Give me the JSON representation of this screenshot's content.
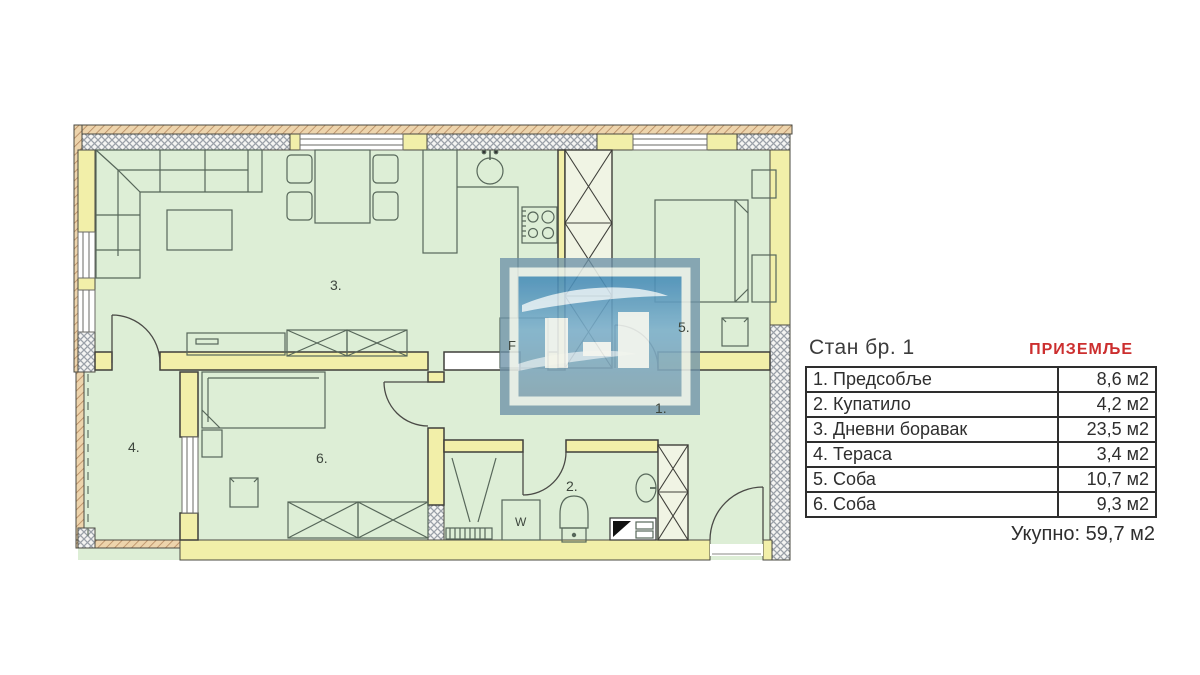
{
  "title": {
    "apartment": "Стан бр. 1",
    "floor": "ПРИЗЕМЉЕ"
  },
  "table": {
    "rows": [
      {
        "name": "1. Предсобље",
        "area": "8,6 м2"
      },
      {
        "name": "2. Купатило",
        "area": "4,2 м2"
      },
      {
        "name": "3. Дневни боравак",
        "area": "23,5 м2"
      },
      {
        "name": "4. Тераса",
        "area": "3,4 м2"
      },
      {
        "name": "5. Соба",
        "area": "10,7 м2"
      },
      {
        "name": "6. Соба",
        "area": "9,3 м2"
      }
    ],
    "total": "Укупно: 59,7 м2"
  },
  "plan": {
    "labels": {
      "hall": "1.",
      "bath": "2.",
      "living": "3.",
      "terrace": "4.",
      "bedroom": "5.",
      "room": "6.",
      "fridge": "F",
      "washer": "W"
    }
  },
  "colors": {
    "floor_green": "#ddeed6",
    "wall_yellow": "#f2efa9",
    "accent_red": "#cc2f2f",
    "watermark_blue": "#6e93a8"
  }
}
